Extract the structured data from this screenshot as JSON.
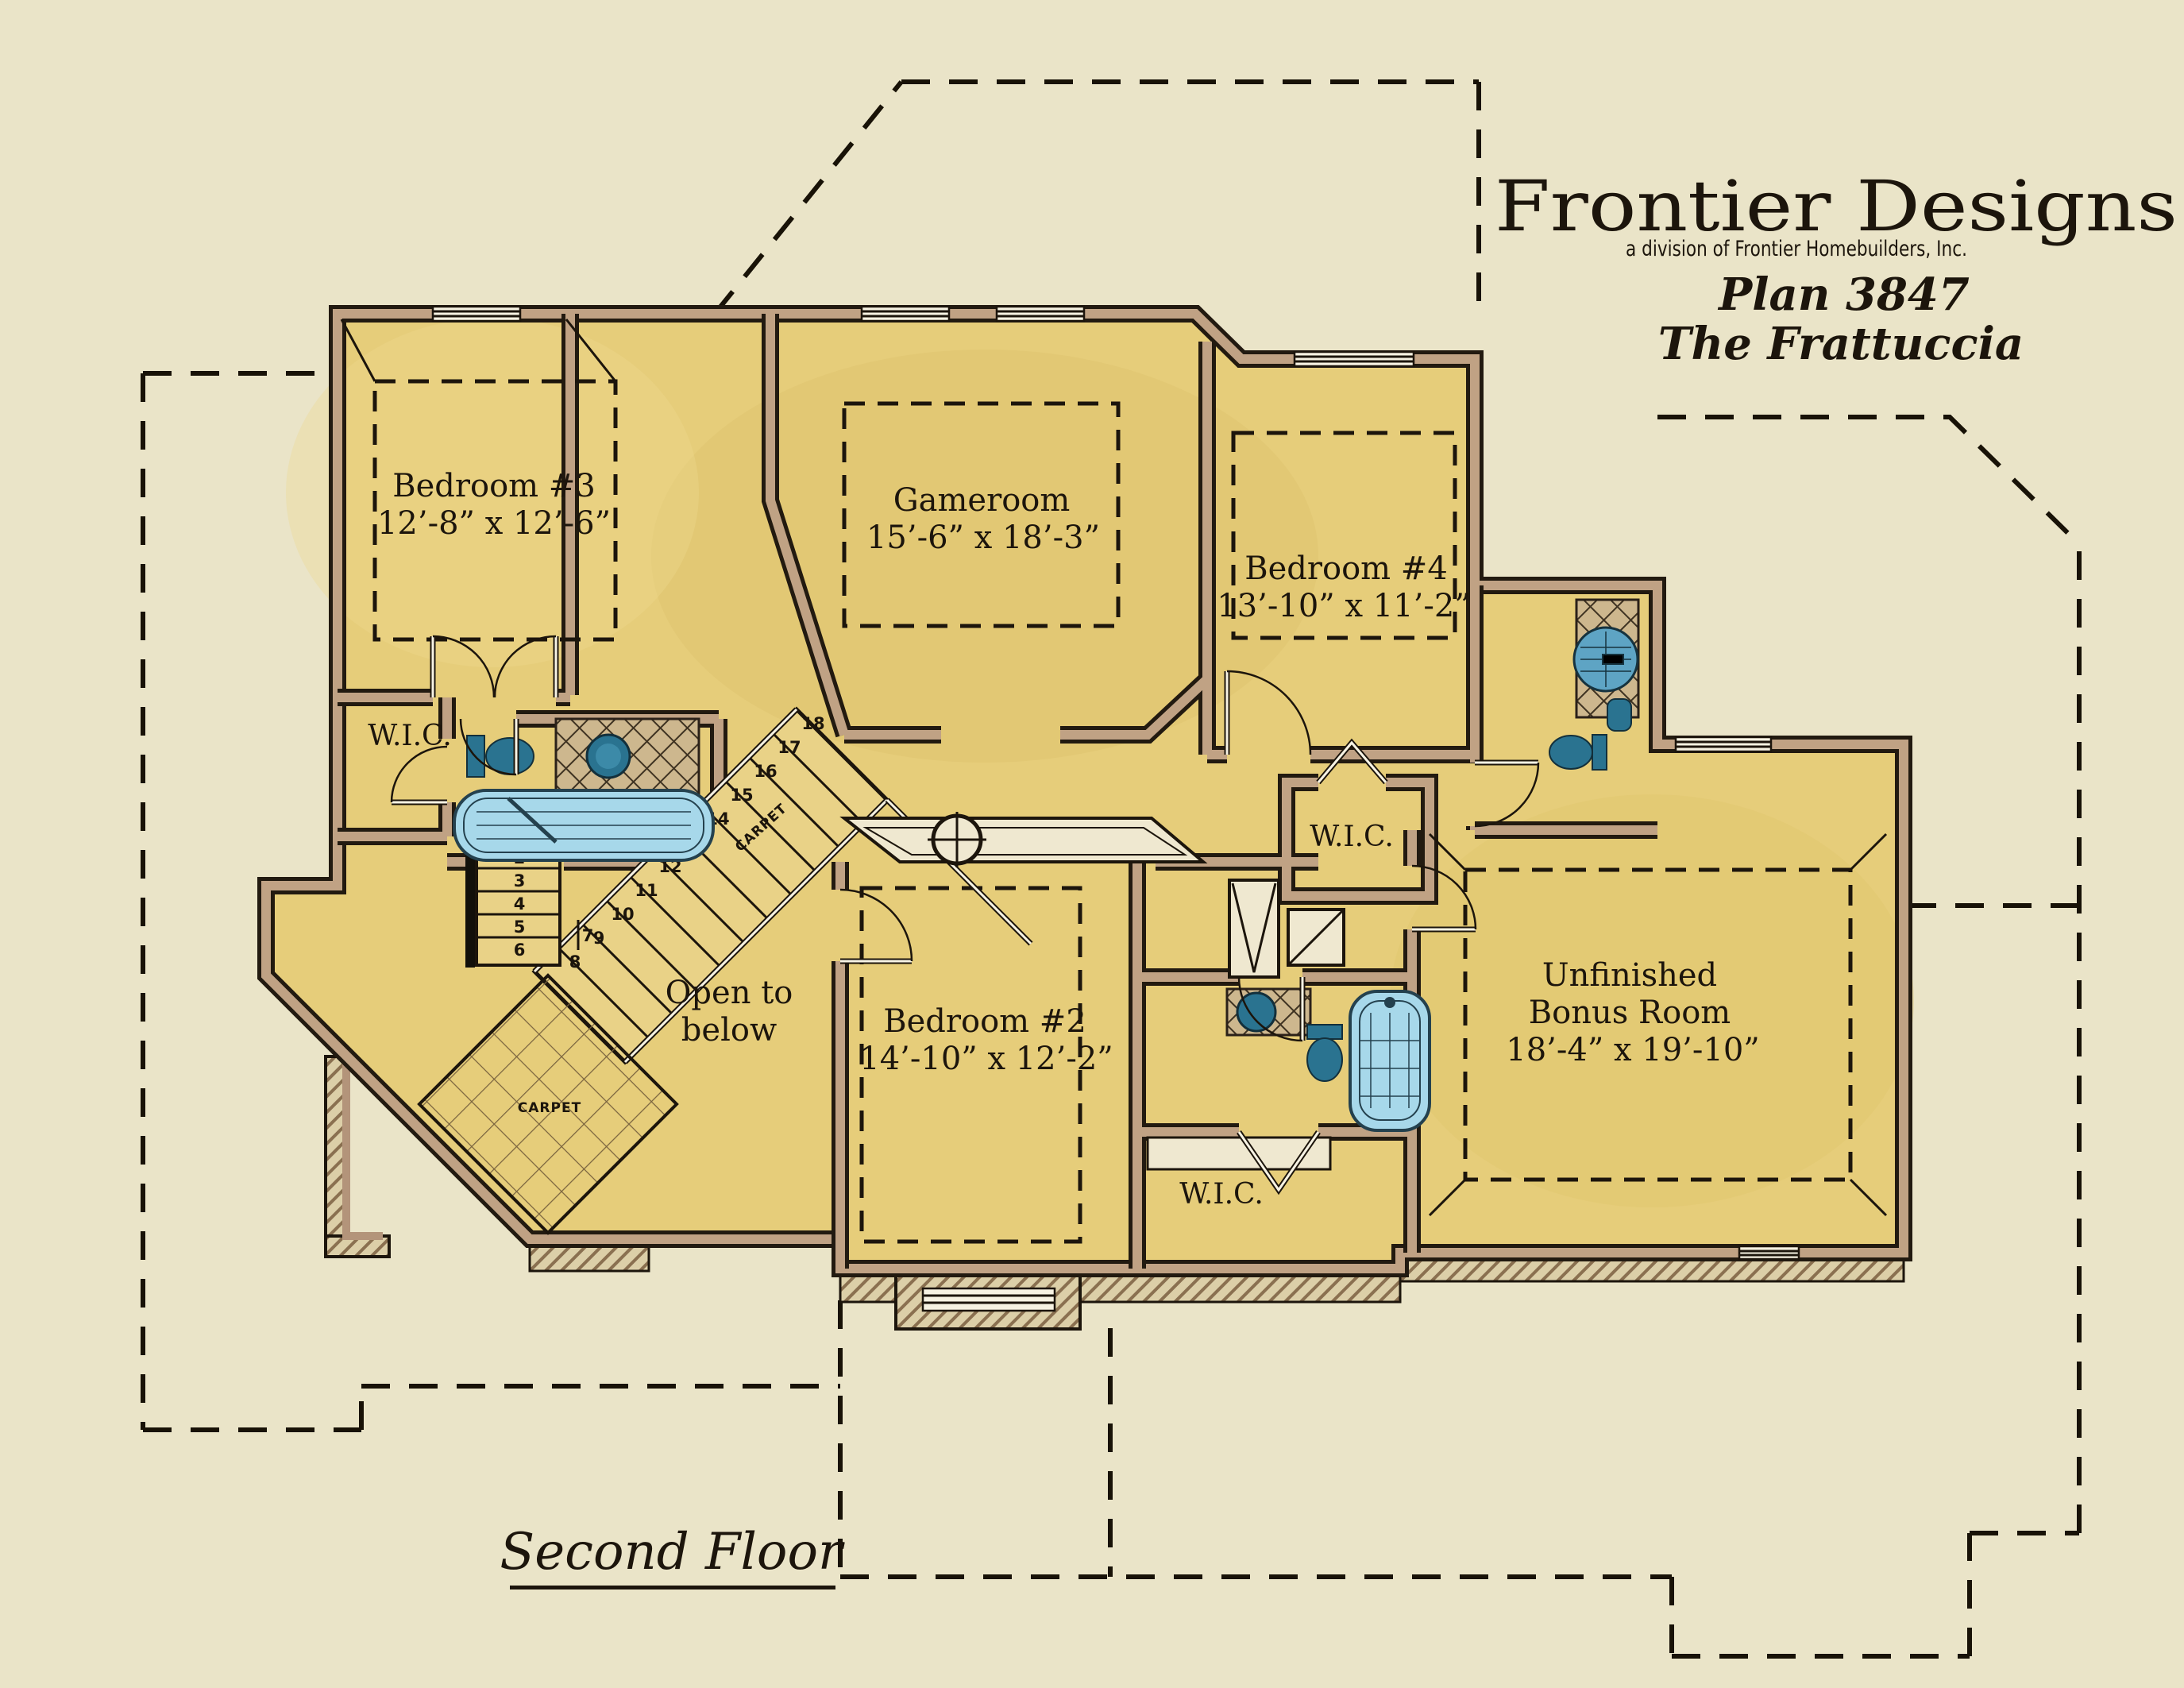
{
  "title_block": {
    "company": "Frontier Designs",
    "division": "a division of Frontier Homebuilders, Inc.",
    "plan_number": "Plan 3847",
    "plan_name": "The Frattuccia"
  },
  "floor_label": "Second Floor",
  "rooms": {
    "bedroom3": {
      "name": "Bedroom #3",
      "dims": "12’-8” x 12’-6”"
    },
    "gameroom": {
      "name": "Gameroom",
      "dims": "15’-6” x 18’-3”"
    },
    "bedroom4": {
      "name": "Bedroom #4",
      "dims": "13’-10” x 11’-2”"
    },
    "bedroom2": {
      "name": "Bedroom #2",
      "dims": "14’-10” x 12’-2”"
    },
    "bonus_room": {
      "line1": "Unfinished",
      "line2": "Bonus Room",
      "dims": "18’-4” x 19’-10”"
    },
    "open_to_below": {
      "line1": "Open to",
      "line2": "below"
    },
    "wic_left": "W.I.C.",
    "wic_middle": "W.I.C.",
    "wic_bottom": "W.I.C."
  },
  "stairs": {
    "treads": [
      "1",
      "2",
      "3",
      "4",
      "5",
      "6",
      "7",
      "8",
      "9",
      "10",
      "11",
      "12",
      "13",
      "14",
      "15",
      "16",
      "17",
      "18"
    ],
    "carpet_upper": "CARPET",
    "carpet_lower": "CARPET"
  },
  "colors": {
    "background": "#eae4c8",
    "floor": "#e6cd7a",
    "wall_fill": "#c0a284",
    "line": "#1c150c",
    "fixture_teal": "#2a7390",
    "fixture_blue": "#a7d8ea"
  }
}
